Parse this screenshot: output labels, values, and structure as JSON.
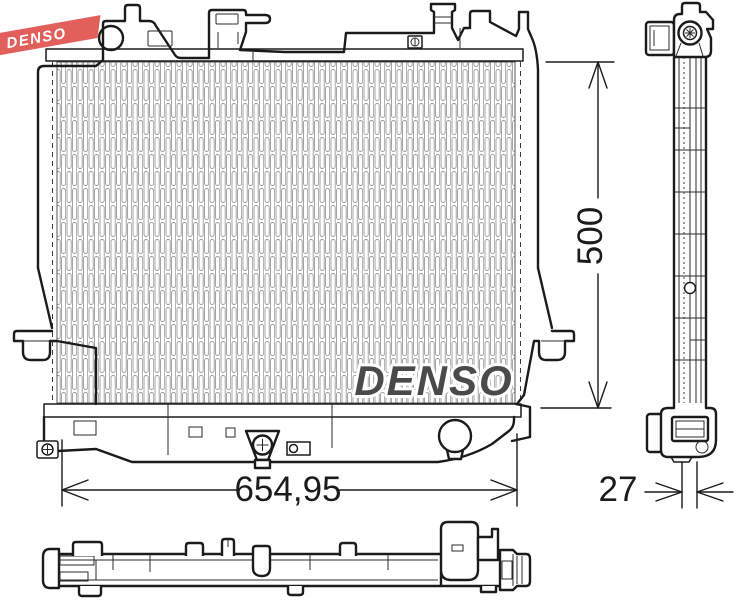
{
  "brand_ribbon": {
    "label": "DENSO",
    "background_color": "#e2605c",
    "text_color": "#ffffff"
  },
  "watermark": {
    "label": "DENSO",
    "fill_color": "#4a4a4a",
    "outline_color": "#ffffff"
  },
  "dimensions": {
    "overall_width": "654,95",
    "core_height": "500",
    "core_depth": "27"
  },
  "drawing_colors": {
    "line": "#1b1b1b",
    "hatch": "#9b9b9b",
    "background": "#ffffff"
  }
}
